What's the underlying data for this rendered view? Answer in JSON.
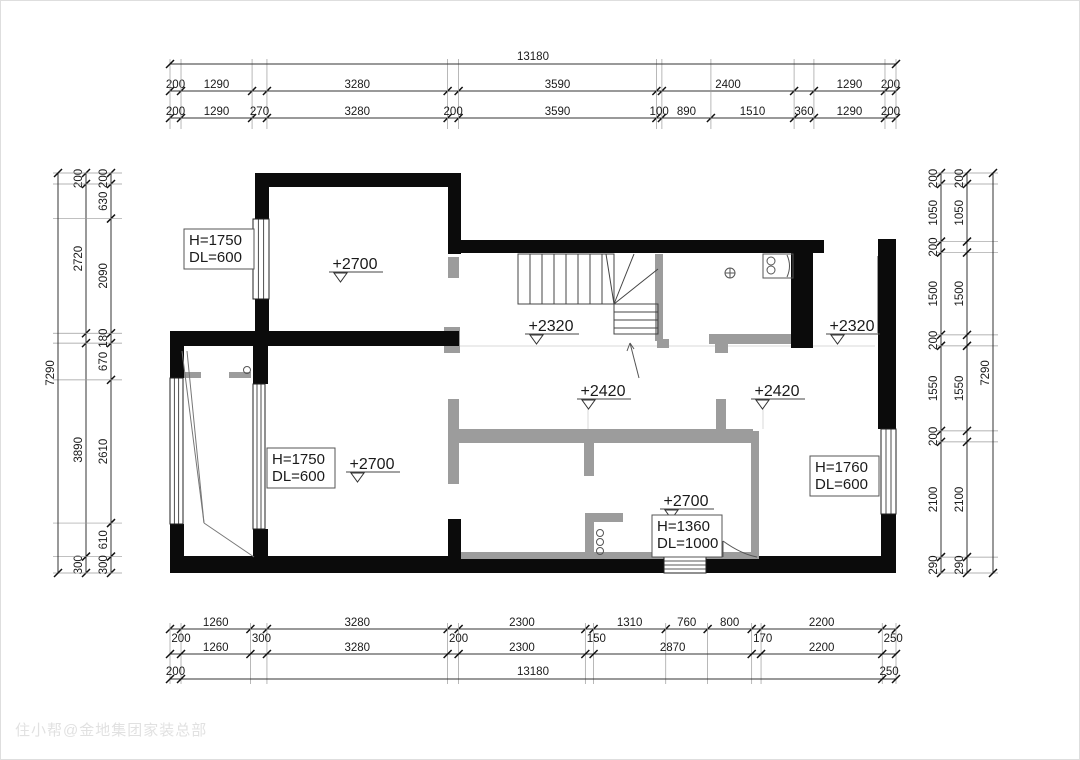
{
  "watermark": "住小帮@金地集团家装总部",
  "colors": {
    "wall": "#0b0b0b",
    "gray_wall": "#9c9c9c",
    "dim_line": "#333333",
    "tick": "#111111",
    "text": "#1a1a1a",
    "ext_line": "#9a9a9a",
    "hairline": "#d9d9d9",
    "fixture": "#555555",
    "box_border": "#555555"
  },
  "plan": {
    "extent_mm": {
      "width": 13180,
      "height": 7290
    },
    "px_box": {
      "x": 169,
      "y": 172,
      "w": 726,
      "h": 400
    },
    "walls_black": [
      [
        254,
        172,
        206,
        14
      ],
      [
        254,
        172,
        14,
        46
      ],
      [
        254,
        298,
        14,
        47
      ],
      [
        447,
        183,
        13,
        70
      ],
      [
        447,
        239,
        376,
        13
      ],
      [
        790,
        252,
        22,
        95
      ],
      [
        877,
        238,
        18,
        190
      ],
      [
        880,
        513,
        15,
        47
      ],
      [
        169,
        330,
        289,
        15
      ],
      [
        169,
        330,
        14,
        47
      ],
      [
        169,
        523,
        14,
        37
      ],
      [
        169,
        555,
        726,
        17
      ],
      [
        252,
        345,
        15,
        38
      ],
      [
        252,
        528,
        15,
        32
      ],
      [
        447,
        518,
        13,
        42
      ]
    ],
    "walls_gray": [
      [
        443,
        326,
        16,
        26
      ],
      [
        447,
        256,
        11,
        21
      ],
      [
        654,
        253,
        8,
        87
      ],
      [
        656,
        338,
        12,
        9
      ],
      [
        708,
        333,
        85,
        10
      ],
      [
        714,
        343,
        13,
        9
      ],
      [
        447,
        398,
        11,
        85
      ],
      [
        458,
        428,
        294,
        14
      ],
      [
        583,
        430,
        10,
        45
      ],
      [
        715,
        398,
        10,
        32
      ],
      [
        750,
        430,
        8,
        127
      ],
      [
        584,
        512,
        9,
        45
      ],
      [
        584,
        512,
        38,
        9
      ],
      [
        181,
        371,
        19,
        6
      ],
      [
        228,
        371,
        22,
        6
      ],
      [
        876,
        255,
        3,
        77
      ]
    ],
    "gray_sills": [
      [
        460,
        551,
        203,
        7
      ],
      [
        705,
        551,
        53,
        7
      ]
    ],
    "windows": [
      [
        252,
        218,
        16,
        80
      ],
      [
        169,
        377,
        13,
        146
      ],
      [
        252,
        383,
        12,
        145
      ],
      [
        880,
        428,
        15,
        85
      ]
    ],
    "steps": {
      "rect": [
        663,
        556,
        42,
        16
      ],
      "lines_y": [
        560,
        564,
        568
      ]
    },
    "stairs": {
      "upper_rect": [
        517,
        253,
        96,
        50
      ],
      "tread_xs": [
        529,
        541,
        553,
        565,
        577,
        589,
        601
      ],
      "lower_rect": [
        613,
        303,
        44,
        30
      ],
      "tread_ys": [
        311,
        319,
        327
      ],
      "fan": [
        [
          613,
          303,
          605,
          253
        ],
        [
          613,
          303,
          633,
          253
        ],
        [
          613,
          303,
          657,
          268
        ]
      ],
      "arrow": {
        "line": [
          638,
          377,
          629,
          342
        ],
        "head": [
          [
            629,
            342,
            626,
            350
          ],
          [
            629,
            342,
            633,
            348
          ]
        ]
      }
    },
    "diagonals": [
      [
        181,
        350,
        203,
        522
      ],
      [
        186,
        350,
        203,
        522
      ],
      [
        203,
        522,
        253,
        556
      ]
    ],
    "hairlines": [
      [
        458,
        345,
        874,
        345
      ],
      [
        587,
        408,
        587,
        428
      ],
      [
        762,
        408,
        762,
        428
      ]
    ],
    "fixtures": {
      "circles": [
        [
          246,
          369,
          3.5
        ],
        [
          599,
          532,
          3.5
        ],
        [
          599,
          541,
          3.5
        ],
        [
          599,
          550,
          3.5
        ],
        [
          770,
          260,
          4
        ],
        [
          770,
          269,
          4
        ]
      ],
      "crossed_circle": {
        "cx": 729,
        "cy": 272,
        "r": 5
      },
      "sink_rect": [
        762,
        253,
        30,
        24
      ],
      "paths": [
        "M786,254 Q791,265 786,276",
        "M722,540 L722,556",
        "M722,540 Q740,553 756,556"
      ]
    },
    "label_boxes": [
      {
        "x": 183,
        "y": 228,
        "w": 70,
        "h": 40,
        "lines": [
          "H=1750",
          "DL=600"
        ]
      },
      {
        "x": 266,
        "y": 447,
        "w": 68,
        "h": 40,
        "lines": [
          "H=1750",
          "DL=600"
        ]
      },
      {
        "x": 651,
        "y": 514,
        "w": 70,
        "h": 42,
        "lines": [
          "H=1360",
          "DL=1000"
        ]
      },
      {
        "x": 809,
        "y": 455,
        "w": 69,
        "h": 40,
        "lines": [
          "H=1760",
          "DL=600"
        ]
      }
    ],
    "elevations": [
      {
        "x": 330,
        "y": 268,
        "text": "+2700"
      },
      {
        "x": 347,
        "y": 468,
        "text": "+2700"
      },
      {
        "x": 526,
        "y": 330,
        "text": "+2320"
      },
      {
        "x": 827,
        "y": 330,
        "text": "+2320"
      },
      {
        "x": 578,
        "y": 395,
        "text": "+2420"
      },
      {
        "x": 752,
        "y": 395,
        "text": "+2420"
      },
      {
        "x": 661,
        "y": 505,
        "text": "+2700"
      }
    ]
  },
  "dimensions": {
    "top": {
      "overall": {
        "pos": 63,
        "value": "13180"
      },
      "chains": [
        {
          "pos": 90,
          "segments": [
            {
              "mm": 200,
              "label": "200"
            },
            {
              "mm": 1290,
              "label": "1290"
            },
            {
              "mm": 270
            },
            {
              "mm": 3280,
              "label": "3280"
            },
            {
              "mm": 200
            },
            {
              "mm": 3590,
              "label": "3590"
            },
            {
              "mm": 100
            },
            {
              "mm": 2400,
              "label": "2400"
            },
            {
              "mm": 360
            },
            {
              "mm": 1290,
              "label": "1290"
            },
            {
              "mm": 200,
              "label": "200"
            }
          ]
        },
        {
          "pos": 117,
          "segments": [
            {
              "mm": 200,
              "label": "200"
            },
            {
              "mm": 1290,
              "label": "1290"
            },
            {
              "mm": 270,
              "label": "270"
            },
            {
              "mm": 3280,
              "label": "3280"
            },
            {
              "mm": 200,
              "label": "200"
            },
            {
              "mm": 3590,
              "label": "3590"
            },
            {
              "mm": 100,
              "label": "100"
            },
            {
              "mm": 890,
              "label": "890"
            },
            {
              "mm": 1510,
              "label": "1510"
            },
            {
              "mm": 360,
              "label": "360"
            },
            {
              "mm": 1290,
              "label": "1290"
            },
            {
              "mm": 200,
              "label": "200"
            }
          ]
        }
      ],
      "ext": [
        58,
        128
      ]
    },
    "bottom": {
      "overall": {
        "pos": 678,
        "value": "13180",
        "left_end": {
          "mm": 200,
          "label": "200"
        },
        "right_end": {
          "mm": 250,
          "label": "250"
        }
      },
      "chains": [
        {
          "pos": 628,
          "segments": [
            {
              "mm": 200,
              "below": "200"
            },
            {
              "mm": 1260,
              "label": "1260"
            },
            {
              "mm": 300,
              "below": "300"
            },
            {
              "mm": 3280,
              "label": "3280"
            },
            {
              "mm": 200,
              "below": "200"
            },
            {
              "mm": 2300,
              "label": "2300"
            },
            {
              "mm": 150,
              "below": "150"
            },
            {
              "mm": 1310,
              "label": "1310"
            },
            {
              "mm": 760,
              "label": "760"
            },
            {
              "mm": 800,
              "label": "800"
            },
            {
              "mm": 170,
              "below": "170"
            },
            {
              "mm": 2200,
              "label": "2200"
            },
            {
              "mm": 250,
              "below": "250"
            }
          ]
        },
        {
          "pos": 653,
          "segments": [
            {
              "mm": 200
            },
            {
              "mm": 1260,
              "label": "1260"
            },
            {
              "mm": 300
            },
            {
              "mm": 3280,
              "label": "3280"
            },
            {
              "mm": 200
            },
            {
              "mm": 2300,
              "label": "2300"
            },
            {
              "mm": 150
            },
            {
              "mm": 2870,
              "label": "2870"
            },
            {
              "mm": 170
            },
            {
              "mm": 2200,
              "label": "2200"
            },
            {
              "mm": 250
            }
          ]
        }
      ],
      "ext": [
        622,
        683
      ]
    },
    "left": {
      "overall": {
        "pos": 57,
        "value": "7290"
      },
      "chains": [
        {
          "pos": 85,
          "segments": [
            {
              "mm": 200,
              "label": "200"
            },
            {
              "mm": 2720,
              "label": "2720"
            },
            {
              "mm": 180
            },
            {
              "mm": 3890,
              "label": "3890"
            },
            {
              "mm": 300,
              "label": "300"
            }
          ]
        },
        {
          "pos": 110,
          "segments": [
            {
              "mm": 200,
              "label": "200"
            },
            {
              "mm": 630,
              "label": "630"
            },
            {
              "mm": 2090,
              "label": "2090"
            },
            {
              "mm": 180,
              "label": "180"
            },
            {
              "mm": 670,
              "label": "670"
            },
            {
              "mm": 2610,
              "label": "2610"
            },
            {
              "mm": 610,
              "label": "610"
            },
            {
              "mm": 300,
              "label": "300"
            }
          ]
        }
      ],
      "ext": [
        52,
        121
      ]
    },
    "right": {
      "overall": {
        "pos": 992,
        "value": "7290"
      },
      "chains": [
        {
          "pos": 940,
          "segments": [
            {
              "mm": 200,
              "label": "200"
            },
            {
              "mm": 1050,
              "label": "1050"
            },
            {
              "mm": 200,
              "label": "200"
            },
            {
              "mm": 1500,
              "label": "1500"
            },
            {
              "mm": 200,
              "label": "200"
            },
            {
              "mm": 1550,
              "label": "1550"
            },
            {
              "mm": 200,
              "label": "200"
            },
            {
              "mm": 2100,
              "label": "2100"
            },
            {
              "mm": 290,
              "label": "290"
            }
          ]
        },
        {
          "pos": 966,
          "segments": [
            {
              "mm": 200,
              "label": "200"
            },
            {
              "mm": 1050,
              "label": "1050"
            },
            {
              "mm": 200
            },
            {
              "mm": 1500,
              "label": "1500"
            },
            {
              "mm": 200
            },
            {
              "mm": 1550,
              "label": "1550"
            },
            {
              "mm": 200
            },
            {
              "mm": 2100,
              "label": "2100"
            },
            {
              "mm": 290,
              "label": "290"
            }
          ]
        }
      ],
      "ext": [
        935,
        997
      ]
    }
  }
}
